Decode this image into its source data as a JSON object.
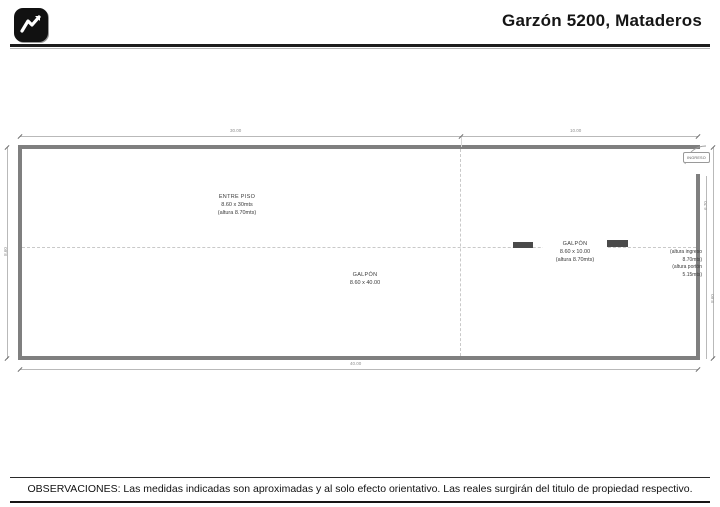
{
  "header": {
    "title": "Garzón 5200, Mataderos",
    "logo_icon": "zigzag-chart-icon"
  },
  "plan": {
    "rooms": {
      "entre_piso": {
        "name": "ENTRE PISO",
        "size": "8.60 x 30mts",
        "height": "(altura 8.70mts)"
      },
      "galpon_main": {
        "name": "GALPÓN",
        "size": "8.60 x 40.00"
      },
      "galpon_right": {
        "name": "GALPÓN",
        "size": "8.60 x 10.00",
        "height": "(altura 8.70mts)"
      }
    },
    "entrance": {
      "label": "INGRESO"
    },
    "notes": {
      "line1": "(altura ingreso",
      "line2": "8.70mts)",
      "line3": "(altura portón",
      "line4": "5.15mts)"
    },
    "dimensions": {
      "top_left": "30.00",
      "top_right": "10.00",
      "bottom": "40.00",
      "left": "8.60",
      "right_inner": "6.70",
      "right_outer": "8.60"
    }
  },
  "footer": {
    "observaciones": "OBSERVACIONES: Las medidas indicadas son aproximadas y al solo efecto orientativo. Las reales surgirán del titulo de propiedad respectivo."
  },
  "colors": {
    "wall": "#7f7f7f",
    "dim_line": "#b9b9b9",
    "dim_text": "#8e8e8e",
    "label_text": "#3a3a3a",
    "column": "#4a4a4a",
    "accent": "#111111"
  }
}
